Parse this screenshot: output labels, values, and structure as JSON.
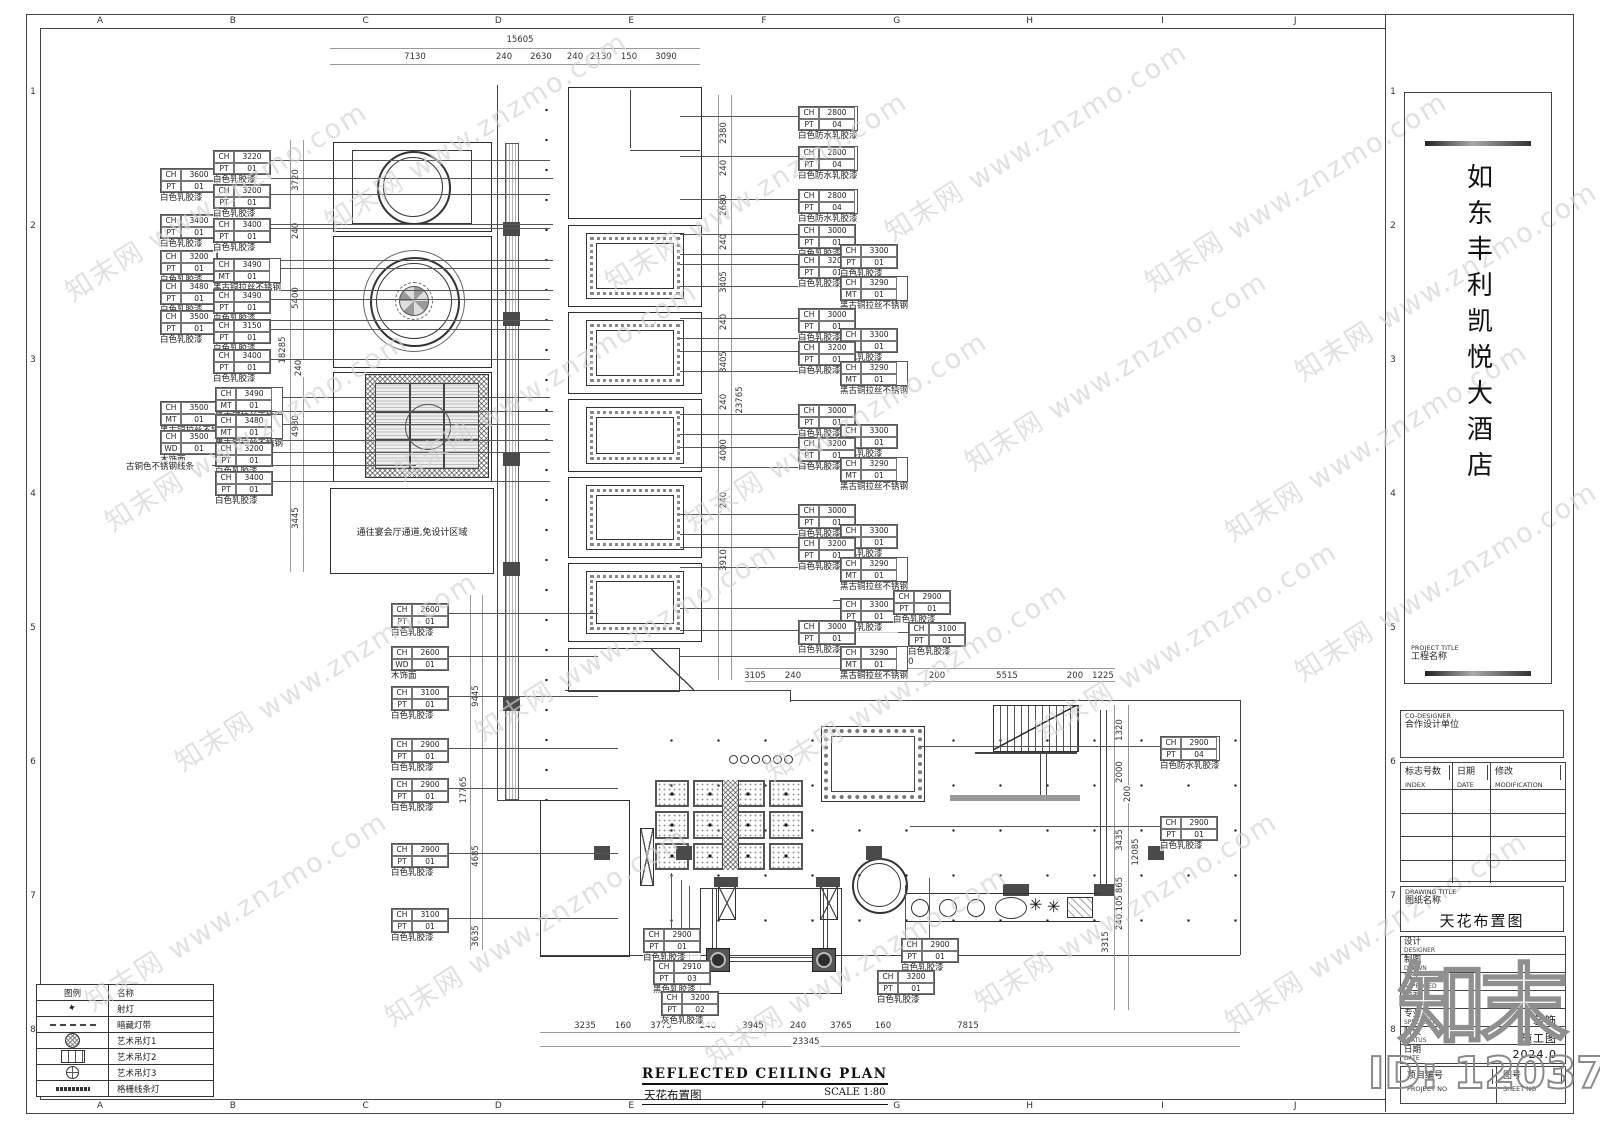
{
  "sheet": {
    "bg": "#ffffff",
    "line": "#444444",
    "dark_fill": "#4a4a4a",
    "watermark_color": "#d2d2d2"
  },
  "grid_refs": {
    "letters": [
      "A",
      "B",
      "C",
      "D",
      "E",
      "F",
      "G",
      "H",
      "I",
      "J"
    ],
    "numbers": [
      "1",
      "2",
      "3",
      "4",
      "5",
      "6",
      "7",
      "8"
    ]
  },
  "watermark": {
    "text": "知末网 www.znzmo.com",
    "positions": [
      [
        40,
        180
      ],
      [
        300,
        110
      ],
      [
        580,
        170
      ],
      [
        860,
        120
      ],
      [
        1120,
        170
      ],
      [
        80,
        410
      ],
      [
        370,
        360
      ],
      [
        660,
        410
      ],
      [
        940,
        350
      ],
      [
        1200,
        420
      ],
      [
        150,
        650
      ],
      [
        450,
        620
      ],
      [
        740,
        660
      ],
      [
        1010,
        620
      ],
      [
        60,
        890
      ],
      [
        360,
        905
      ],
      [
        680,
        945
      ],
      [
        950,
        890
      ],
      [
        1200,
        910
      ],
      [
        1270,
        260
      ],
      [
        1270,
        560
      ]
    ]
  },
  "site_mark": {
    "logo": "知末",
    "id": "ID: 1203765827"
  },
  "plan": {
    "no_design_area_text": "通往宴会厅通道,免设计区域",
    "free_labels": [
      {
        "x": 126,
        "y": 460,
        "text": "古铜色不锈钢线条",
        "len": 204
      }
    ],
    "callouts": [
      {
        "x": 160,
        "y": 168,
        "ch": "3600",
        "m": "PT",
        "mv": "01",
        "t": "白色乳胶漆",
        "d": "r",
        "l": 336
      },
      {
        "x": 160,
        "y": 214,
        "ch": "3400",
        "m": "PT",
        "mv": "01",
        "t": "白色乳胶漆",
        "d": "r",
        "l": 336
      },
      {
        "x": 160,
        "y": 250,
        "ch": "3200",
        "m": "PT",
        "mv": "01",
        "t": "白色乳胶漆",
        "d": "r",
        "l": 336
      },
      {
        "x": 160,
        "y": 280,
        "ch": "3480",
        "m": "PT",
        "mv": "01",
        "t": "白色乳胶漆",
        "d": "r",
        "l": 336
      },
      {
        "x": 160,
        "y": 310,
        "ch": "3500",
        "m": "PT",
        "mv": "01",
        "t": "白色乳胶漆",
        "d": "r",
        "l": 336
      },
      {
        "x": 213,
        "y": 150,
        "ch": "3220",
        "m": "PT",
        "mv": "01",
        "t": "白色乳胶漆",
        "d": "r",
        "l": 280
      },
      {
        "x": 213,
        "y": 184,
        "ch": "3200",
        "m": "PT",
        "mv": "01",
        "t": "白色乳胶漆",
        "d": "r",
        "l": 280
      },
      {
        "x": 213,
        "y": 218,
        "ch": "3400",
        "m": "PT",
        "mv": "01",
        "t": "白色乳胶漆",
        "d": "r",
        "l": 280
      },
      {
        "x": 213,
        "y": 258,
        "ch": "3490",
        "m": "MT",
        "mv": "01",
        "t": "黑古铜拉丝不锈钢",
        "d": "r",
        "l": 280
      },
      {
        "x": 213,
        "y": 289,
        "ch": "3490",
        "m": "PT",
        "mv": "01",
        "t": "白色乳胶漆",
        "d": "r",
        "l": 280
      },
      {
        "x": 213,
        "y": 319,
        "ch": "3150",
        "m": "PT",
        "mv": "01",
        "t": "白色乳胶漆",
        "d": "r",
        "l": 280
      },
      {
        "x": 213,
        "y": 349,
        "ch": "3400",
        "m": "PT",
        "mv": "01",
        "t": "白色乳胶漆",
        "d": "r",
        "l": 280
      },
      {
        "x": 160,
        "y": 401,
        "ch": "3500",
        "m": "MT",
        "mv": "01",
        "t": "黑古铜拉丝不锈钢",
        "d": "r",
        "l": 336
      },
      {
        "x": 160,
        "y": 430,
        "ch": "3500",
        "m": "WD",
        "mv": "01",
        "t": "木饰面",
        "d": "r",
        "l": 336
      },
      {
        "x": 215,
        "y": 387,
        "ch": "3490",
        "m": "MT",
        "mv": "01",
        "t": "黑古铜拉丝不锈钢",
        "d": "r",
        "l": 278
      },
      {
        "x": 215,
        "y": 414,
        "ch": "3480",
        "m": "MT",
        "mv": "01",
        "t": "黑古铜拉丝不锈钢",
        "d": "r",
        "l": 278
      },
      {
        "x": 215,
        "y": 442,
        "ch": "3200",
        "m": "PT",
        "mv": "01",
        "t": "白色乳胶漆",
        "d": "r",
        "l": 278
      },
      {
        "x": 215,
        "y": 471,
        "ch": "3400",
        "m": "PT",
        "mv": "01",
        "t": "白色乳胶漆",
        "d": "r",
        "l": 278
      },
      {
        "x": 391,
        "y": 603,
        "ch": "2600",
        "m": "PT",
        "mv": "01",
        "t": "白色乳胶漆",
        "d": "r",
        "l": 150
      },
      {
        "x": 391,
        "y": 646,
        "ch": "2600",
        "m": "WD",
        "mv": "01",
        "t": "木饰面",
        "d": "r",
        "l": 150
      },
      {
        "x": 391,
        "y": 686,
        "ch": "3100",
        "m": "PT",
        "mv": "01",
        "t": "白色乳胶漆",
        "d": "r",
        "l": 150
      },
      {
        "x": 391,
        "y": 738,
        "ch": "2900",
        "m": "PT",
        "mv": "01",
        "t": "白色乳胶漆",
        "d": "r",
        "l": 170
      },
      {
        "x": 391,
        "y": 778,
        "ch": "2900",
        "m": "PT",
        "mv": "01",
        "t": "白色乳胶漆",
        "d": "r",
        "l": 170
      },
      {
        "x": 391,
        "y": 843,
        "ch": "2900",
        "m": "PT",
        "mv": "01",
        "t": "白色乳胶漆",
        "d": "r",
        "l": 170
      },
      {
        "x": 391,
        "y": 908,
        "ch": "3100",
        "m": "PT",
        "mv": "01",
        "t": "白色乳胶漆",
        "d": "r",
        "l": 170
      },
      {
        "x": 798,
        "y": 106,
        "ch": "2800",
        "m": "PT",
        "mv": "04",
        "t": "白色防水乳胶漆",
        "d": "l",
        "l": 118
      },
      {
        "x": 798,
        "y": 146,
        "ch": "2800",
        "m": "PT",
        "mv": "04",
        "t": "白色防水乳胶漆",
        "d": "l",
        "l": 118
      },
      {
        "x": 798,
        "y": 189,
        "ch": "2800",
        "m": "PT",
        "mv": "04",
        "t": "白色防水乳胶漆",
        "d": "l",
        "l": 118
      },
      {
        "x": 798,
        "y": 224,
        "ch": "3000",
        "m": "PT",
        "mv": "01",
        "t": "白色乳胶漆",
        "d": "l",
        "l": 118
      },
      {
        "x": 798,
        "y": 254,
        "ch": "3200",
        "m": "PT",
        "mv": "01",
        "t": "白色乳胶漆",
        "d": "l",
        "l": 118
      },
      {
        "x": 840,
        "y": 244,
        "ch": "3300",
        "m": "PT",
        "mv": "01",
        "t": "白色乳胶漆",
        "d": "l",
        "l": 160
      },
      {
        "x": 840,
        "y": 276,
        "ch": "3290",
        "m": "MT",
        "mv": "01",
        "t": "黑古铜拉丝不锈钢",
        "d": "l",
        "l": 160
      },
      {
        "x": 798,
        "y": 308,
        "ch": "3000",
        "m": "PT",
        "mv": "01",
        "t": "白色乳胶漆",
        "d": "l",
        "l": 118
      },
      {
        "x": 840,
        "y": 328,
        "ch": "3300",
        "m": "PT",
        "mv": "01",
        "t": "白色乳胶漆",
        "d": "l",
        "l": 160
      },
      {
        "x": 798,
        "y": 341,
        "ch": "3200",
        "m": "PT",
        "mv": "01",
        "t": "白色乳胶漆",
        "d": "l",
        "l": 118
      },
      {
        "x": 840,
        "y": 361,
        "ch": "3290",
        "m": "MT",
        "mv": "01",
        "t": "黑古铜拉丝不锈钢",
        "d": "l",
        "l": 160
      },
      {
        "x": 798,
        "y": 404,
        "ch": "3000",
        "m": "PT",
        "mv": "01",
        "t": "白色乳胶漆",
        "d": "l",
        "l": 118
      },
      {
        "x": 840,
        "y": 424,
        "ch": "3300",
        "m": "PT",
        "mv": "01",
        "t": "白色乳胶漆",
        "d": "l",
        "l": 160
      },
      {
        "x": 798,
        "y": 437,
        "ch": "3200",
        "m": "PT",
        "mv": "01",
        "t": "白色乳胶漆",
        "d": "l",
        "l": 118
      },
      {
        "x": 840,
        "y": 457,
        "ch": "3290",
        "m": "MT",
        "mv": "01",
        "t": "黑古铜拉丝不锈钢",
        "d": "l",
        "l": 160
      },
      {
        "x": 798,
        "y": 504,
        "ch": "3000",
        "m": "PT",
        "mv": "01",
        "t": "白色乳胶漆",
        "d": "l",
        "l": 118
      },
      {
        "x": 840,
        "y": 524,
        "ch": "3300",
        "m": "PT",
        "mv": "01",
        "t": "白色乳胶漆",
        "d": "l",
        "l": 160
      },
      {
        "x": 798,
        "y": 537,
        "ch": "3200",
        "m": "PT",
        "mv": "01",
        "t": "白色乳胶漆",
        "d": "l",
        "l": 118
      },
      {
        "x": 840,
        "y": 557,
        "ch": "3290",
        "m": "MT",
        "mv": "01",
        "t": "黑古铜拉丝不锈钢",
        "d": "l",
        "l": 160
      },
      {
        "x": 840,
        "y": 598,
        "ch": "3300",
        "m": "PT",
        "mv": "01",
        "t": "白色乳胶漆",
        "d": "l",
        "l": 160
      },
      {
        "x": 798,
        "y": 620,
        "ch": "3000",
        "m": "PT",
        "mv": "01",
        "t": "白色乳胶漆",
        "d": "l",
        "l": 118
      },
      {
        "x": 840,
        "y": 646,
        "ch": "3290",
        "m": "MT",
        "mv": "01",
        "t": "黑古铜拉丝不锈钢",
        "d": "l",
        "l": 160
      },
      {
        "x": 893,
        "y": 590,
        "ch": "2900",
        "m": "PT",
        "mv": "01",
        "t": "白色乳胶漆",
        "d": "l",
        "l": 60
      },
      {
        "x": 908,
        "y": 622,
        "ch": "3100",
        "m": "PT",
        "mv": "01",
        "t": "白色乳胶漆",
        "d": "l",
        "l": 60
      },
      {
        "x": 1160,
        "y": 736,
        "ch": "2900",
        "m": "PT",
        "mv": "04",
        "t": "白色防水乳胶漆",
        "d": "l",
        "l": 240
      },
      {
        "x": 1160,
        "y": 816,
        "ch": "2900",
        "m": "PT",
        "mv": "01",
        "t": "白色乳胶漆",
        "d": "l",
        "l": 250
      },
      {
        "x": 643,
        "y": 928,
        "ch": "2900",
        "m": "PT",
        "mv": "01",
        "t": "白色乳胶漆",
        "d": "u",
        "l": 55
      },
      {
        "x": 653,
        "y": 960,
        "ch": "2910",
        "m": "PT",
        "mv": "03",
        "t": "黑色乳胶漆",
        "d": "u",
        "l": 80
      },
      {
        "x": 661,
        "y": 991,
        "ch": "3200",
        "m": "PT",
        "mv": "02",
        "t": "灰色乳胶漆",
        "d": "u",
        "l": 105
      },
      {
        "x": 901,
        "y": 938,
        "ch": "2900",
        "m": "PT",
        "mv": "01",
        "t": "白色乳胶漆",
        "d": "u",
        "l": 60
      },
      {
        "x": 877,
        "y": 970,
        "ch": "3200",
        "m": "PT",
        "mv": "01",
        "t": "白色乳胶漆",
        "d": "u",
        "l": 85
      }
    ],
    "dims": [
      {
        "x": 520,
        "y": 40,
        "t": "15605"
      },
      {
        "x": 415,
        "y": 57,
        "t": "7130"
      },
      {
        "x": 504,
        "y": 57,
        "t": "240"
      },
      {
        "x": 541,
        "y": 57,
        "t": "2630"
      },
      {
        "x": 575,
        "y": 57,
        "t": "240"
      },
      {
        "x": 601,
        "y": 57,
        "t": "2130"
      },
      {
        "x": 629,
        "y": 57,
        "t": "150"
      },
      {
        "x": 666,
        "y": 57,
        "t": "3090"
      },
      {
        "x": 296,
        "y": 180,
        "t": "3720",
        "v": 1
      },
      {
        "x": 296,
        "y": 231,
        "t": "240",
        "v": 1
      },
      {
        "x": 296,
        "y": 298,
        "t": "5400",
        "v": 1
      },
      {
        "x": 283,
        "y": 350,
        "t": "18285",
        "v": 1
      },
      {
        "x": 299,
        "y": 368,
        "t": "240",
        "v": 1
      },
      {
        "x": 296,
        "y": 426,
        "t": "4980",
        "v": 1
      },
      {
        "x": 296,
        "y": 518,
        "t": "3445",
        "v": 1
      },
      {
        "x": 476,
        "y": 696,
        "t": "9445",
        "v": 1
      },
      {
        "x": 464,
        "y": 790,
        "t": "17765",
        "v": 1
      },
      {
        "x": 476,
        "y": 856,
        "t": "4685",
        "v": 1
      },
      {
        "x": 476,
        "y": 936,
        "t": "3635",
        "v": 1
      },
      {
        "x": 724,
        "y": 133,
        "t": "2380",
        "v": 1
      },
      {
        "x": 724,
        "y": 168,
        "t": "240",
        "v": 1
      },
      {
        "x": 724,
        "y": 205,
        "t": "2680",
        "v": 1
      },
      {
        "x": 724,
        "y": 242,
        "t": "240",
        "v": 1
      },
      {
        "x": 724,
        "y": 282,
        "t": "3405",
        "v": 1
      },
      {
        "x": 724,
        "y": 322,
        "t": "240",
        "v": 1
      },
      {
        "x": 724,
        "y": 362,
        "t": "3405",
        "v": 1
      },
      {
        "x": 724,
        "y": 402,
        "t": "240",
        "v": 1
      },
      {
        "x": 740,
        "y": 400,
        "t": "23765",
        "v": 1
      },
      {
        "x": 724,
        "y": 450,
        "t": "4000",
        "v": 1
      },
      {
        "x": 724,
        "y": 500,
        "t": "240",
        "v": 1
      },
      {
        "x": 724,
        "y": 560,
        "t": "3910",
        "v": 1
      },
      {
        "x": 900,
        "y": 662,
        "t": "16350"
      },
      {
        "x": 755,
        "y": 676,
        "t": "3105"
      },
      {
        "x": 793,
        "y": 676,
        "t": "240"
      },
      {
        "x": 862,
        "y": 676,
        "t": "5870"
      },
      {
        "x": 937,
        "y": 676,
        "t": "200"
      },
      {
        "x": 1007,
        "y": 676,
        "t": "5515"
      },
      {
        "x": 1075,
        "y": 676,
        "t": "200"
      },
      {
        "x": 1103,
        "y": 676,
        "t": "1225"
      },
      {
        "x": 1120,
        "y": 730,
        "t": "1320",
        "v": 1
      },
      {
        "x": 1120,
        "y": 772,
        "t": "2000",
        "v": 1
      },
      {
        "x": 1128,
        "y": 794,
        "t": "200",
        "v": 1
      },
      {
        "x": 1120,
        "y": 840,
        "t": "3435",
        "v": 1
      },
      {
        "x": 1136,
        "y": 852,
        "t": "12085",
        "v": 1
      },
      {
        "x": 1120,
        "y": 885,
        "t": "865",
        "v": 1
      },
      {
        "x": 1120,
        "y": 906,
        "t": "1105",
        "v": 1
      },
      {
        "x": 1120,
        "y": 922,
        "t": "240",
        "v": 1
      },
      {
        "x": 1106,
        "y": 942,
        "t": "3315",
        "v": 1
      },
      {
        "x": 585,
        "y": 1026,
        "t": "3235"
      },
      {
        "x": 623,
        "y": 1026,
        "t": "160"
      },
      {
        "x": 661,
        "y": 1026,
        "t": "3775"
      },
      {
        "x": 708,
        "y": 1026,
        "t": "240"
      },
      {
        "x": 753,
        "y": 1026,
        "t": "3945"
      },
      {
        "x": 798,
        "y": 1026,
        "t": "240"
      },
      {
        "x": 841,
        "y": 1026,
        "t": "3765"
      },
      {
        "x": 883,
        "y": 1026,
        "t": "160"
      },
      {
        "x": 968,
        "y": 1026,
        "t": "7815"
      },
      {
        "x": 806,
        "y": 1042,
        "t": "23345"
      }
    ]
  },
  "legend": {
    "headers": [
      "图例",
      "名称"
    ],
    "rows": [
      {
        "icon": "spot",
        "name": "射灯"
      },
      {
        "icon": "strip",
        "name": "暗藏灯带"
      },
      {
        "icon": "ch1",
        "name": "艺术吊灯1"
      },
      {
        "icon": "ch2",
        "name": "艺术吊灯2"
      },
      {
        "icon": "ch3",
        "name": "艺术吊灯3"
      },
      {
        "icon": "lin",
        "name": "格栅线条灯"
      }
    ]
  },
  "plan_title": {
    "en": "REFLECTED CEILING PLAN",
    "zh": "天花布置图",
    "scale": "SCALE 1:80"
  },
  "title_block": {
    "project_label_en": "PROJECT TITLE",
    "project_label_zh": "工程名称",
    "project_name": "如东丰利凯悦大酒店",
    "co_designer_en": "CO-DESIGNER",
    "co_designer_zh": "合作设计单位",
    "index_headers": [
      {
        "zh": "标志号数",
        "en": "INDEX"
      },
      {
        "zh": "日期",
        "en": "DATE"
      },
      {
        "zh": "修改",
        "en": "MODIFICATION"
      }
    ],
    "index_empty_rows": 4,
    "drawing_label_en": "DRAWING TITLE",
    "drawing_label_zh": "图纸名称",
    "drawing_title": "天花布置图",
    "fields": [
      {
        "zh": "设计",
        "en": "DESIGNER",
        "value": ""
      },
      {
        "zh": "制图",
        "en": "DRAWN",
        "value": ""
      },
      {
        "zh": "审定",
        "en": "APPROVED",
        "value": ""
      },
      {
        "zh": "校对",
        "en": "CHECKED",
        "value": ""
      },
      {
        "zh": "专业",
        "en": "SPECIALTY",
        "value": "装饰"
      },
      {
        "zh": "阶段",
        "en": "STATUS",
        "value": "施工图"
      },
      {
        "zh": "日期",
        "en": "DATE",
        "value": "2024.0"
      }
    ],
    "footer": [
      {
        "zh": "项目编号",
        "en": "PROJECT NO"
      },
      {
        "zh": "图号",
        "en": "SHEET NO"
      }
    ]
  }
}
